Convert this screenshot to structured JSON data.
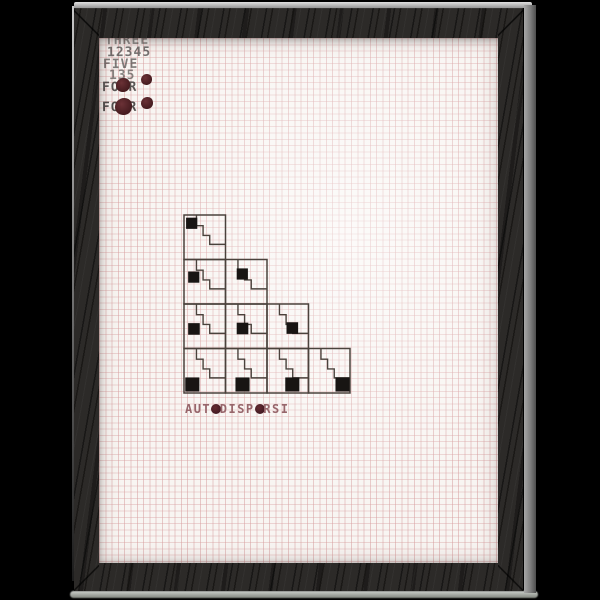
{
  "scene": {
    "description": "Photo of framed typewriter-art print on graph paper, black background",
    "background_color": "#000000"
  },
  "frame": {
    "wood_color": "#2c2a28",
    "top_edge_highlight": "#d9d9d9",
    "side_edge_highlight": "#8f8f8f",
    "bottom_reflection": "#b2b6b0"
  },
  "paper": {
    "color": "#f8f5f2",
    "grid_color": "#d08a8c",
    "grid_spacing_px": 6.3
  },
  "stamp_block": {
    "ink_color": "#3f3c3b",
    "blob_color": "#4e2125",
    "lines": [
      {
        "text": "THREE",
        "x": 6,
        "y": -5,
        "opacity": 0.55
      },
      {
        "text": "12345",
        "x": 8,
        "y": 7,
        "opacity": 0.7
      },
      {
        "text": "FIVE",
        "x": 4,
        "y": 19,
        "opacity": 0.65
      },
      {
        "text": "135",
        "x": 10,
        "y": 30,
        "opacity": 0.6
      },
      {
        "text": "FOUR",
        "x": 3,
        "y": 42,
        "opacity": 0.85
      },
      {
        "text": "FOUR",
        "x": 3,
        "y": 62,
        "opacity": 0.9
      }
    ],
    "blobs": [
      {
        "x": 17,
        "y": 40,
        "d": 14
      },
      {
        "x": 42,
        "y": 36,
        "d": 11
      },
      {
        "x": 16,
        "y": 60,
        "d": 17
      },
      {
        "x": 42,
        "y": 59,
        "d": 12
      }
    ]
  },
  "pattern": {
    "cell": {
      "w": 41.5,
      "h": 44.5
    },
    "stroke_color": "#4a423c",
    "square_color": "#181513",
    "stair_points": [
      [
        0.3,
        0
      ],
      [
        0.3,
        0.24
      ],
      [
        0.46,
        0.24
      ],
      [
        0.46,
        0.46
      ],
      [
        0.62,
        0.46
      ],
      [
        0.62,
        0.66
      ],
      [
        1,
        0.66
      ]
    ],
    "rows": [
      [
        {
          "x": 0.05,
          "y": 0.06,
          "s": 0.27
        }
      ],
      [
        {
          "x": 0.1,
          "y": 0.27,
          "s": 0.27
        },
        {
          "x": 0.27,
          "y": 0.2,
          "s": 0.27
        }
      ],
      [
        {
          "x": 0.1,
          "y": 0.43,
          "s": 0.28
        },
        {
          "x": 0.27,
          "y": 0.42,
          "s": 0.28
        },
        {
          "x": 0.47,
          "y": 0.41,
          "s": 0.28
        }
      ],
      [
        {
          "x": 0.03,
          "y": 0.65,
          "s": 0.34
        },
        {
          "x": 0.24,
          "y": 0.65,
          "s": 0.34
        },
        {
          "x": 0.44,
          "y": 0.65,
          "s": 0.34
        },
        {
          "x": 0.65,
          "y": 0.65,
          "s": 0.34
        }
      ]
    ]
  },
  "title": {
    "text": "AUTODISPERSI",
    "filled_indices": [
      3,
      8
    ],
    "ink_color": "#97666b",
    "blob_color": "#532229",
    "x": 86,
    "y": 364,
    "letter_pitch": 8.7,
    "font_size": 12
  }
}
